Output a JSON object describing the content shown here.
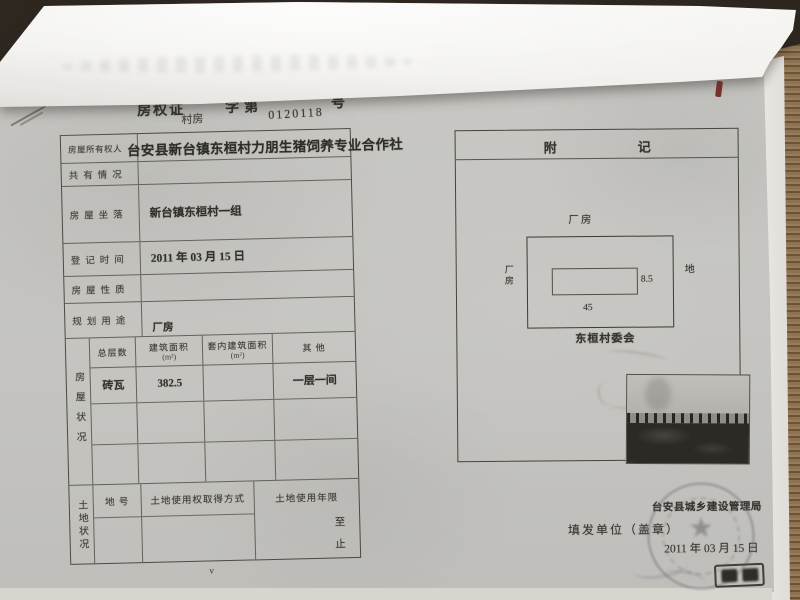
{
  "doc": {
    "header": {
      "title": "房权证",
      "fill_category": "村房",
      "zi_di": "字第",
      "serial": "0120118",
      "hao": "号"
    },
    "fields": [
      {
        "label": "房屋所有权人",
        "value": "台安县新台镇东桓村力朋生猪饲养专业合作社"
      },
      {
        "label": "共有情况",
        "value": ""
      },
      {
        "label": "房屋坐落",
        "value": "新台镇东桓村一组"
      },
      {
        "label": "登记时间",
        "value": "2011 年 03 月 15 日"
      },
      {
        "label": "房屋性质",
        "value": ""
      },
      {
        "label": "规划用途",
        "value": "厂房"
      }
    ],
    "house_status": {
      "side_label": "房屋状况",
      "columns": [
        {
          "line1": "总层数",
          "line2": ""
        },
        {
          "line1": "建筑面积",
          "line2": "(m²)"
        },
        {
          "line1": "套内建筑面积",
          "line2": "(m²)"
        },
        {
          "line1": "其  他",
          "line2": ""
        }
      ],
      "rows": [
        {
          "floors": "砖瓦",
          "area": "382.5",
          "inner_area": "",
          "other": "一层一间"
        },
        {
          "floors": "",
          "area": "",
          "inner_area": "",
          "other": ""
        },
        {
          "floors": "",
          "area": "",
          "inner_area": "",
          "other": ""
        }
      ]
    },
    "land_status": {
      "side_label": "土地状况",
      "columns": [
        "地  号",
        "土地使用权取得方式",
        "土地使用年限"
      ],
      "term_to": "至",
      "term_stop": "止",
      "check_mark": "v"
    },
    "annex": {
      "title_left": "附",
      "title_right": "记",
      "plot": {
        "top_label": "厂房",
        "left_label": "厂房",
        "right_label": "地",
        "length": "45",
        "width": "8.5",
        "owner_label": "东桓村委会"
      }
    },
    "footer": {
      "agency": "台安县城乡建设管理局",
      "issue_label": "填发单位（盖章）",
      "date": "2011 年 03 月 15 日"
    }
  }
}
